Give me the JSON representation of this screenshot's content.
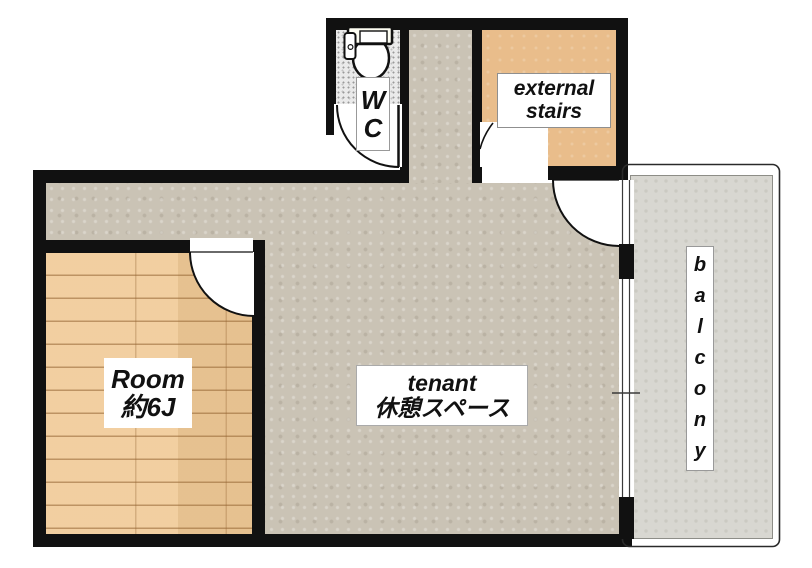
{
  "plan_type": "floor-plan",
  "colors": {
    "wall": "#111111",
    "wood_floor": "#f0ca96",
    "tenant_floor": "#cac3b5",
    "wc_floor": "#eaeaea",
    "stairs_floor": "#e9bd8b",
    "balcony_floor": "#d8d7d1",
    "text": "#111111"
  },
  "rooms": {
    "wc": {
      "name": "WC",
      "lines": [
        "W",
        "C"
      ]
    },
    "external_stairs": {
      "name": "external stairs",
      "lines": [
        "external",
        "stairs"
      ]
    },
    "room": {
      "name": "Room 約6J",
      "lines": [
        "Room",
        "約6J"
      ]
    },
    "tenant": {
      "name": "tenant 休憩スペース",
      "lines": [
        "tenant",
        "休憩スペース"
      ]
    },
    "balcony": {
      "name": "balcony",
      "letters": [
        "b",
        "a",
        "l",
        "c",
        "o",
        "n",
        "y"
      ]
    }
  }
}
